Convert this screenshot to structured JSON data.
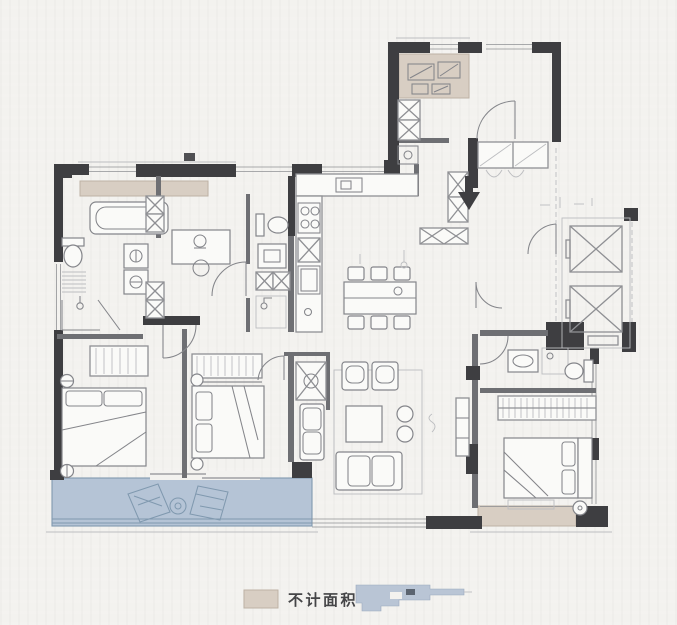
{
  "legend": {
    "not_counted_label": "不计面积"
  },
  "colors": {
    "background": "#f3f2ef",
    "paper": "#fafaf8",
    "wall": "#3e3e41",
    "wall_mid": "#6e6f73",
    "line": "#8f9094",
    "line_light": "#bcbdc0",
    "furniture": "#84858a",
    "beige_fill": "#d8cec3",
    "beige_stroke": "#beb2a5",
    "balcony_fill": "#b5c4d6",
    "balcony_stroke": "#8099af",
    "keyplan_fill": "#b9c5d5",
    "keyplan_stroke": "#9aa9bd",
    "text": "#454547"
  }
}
